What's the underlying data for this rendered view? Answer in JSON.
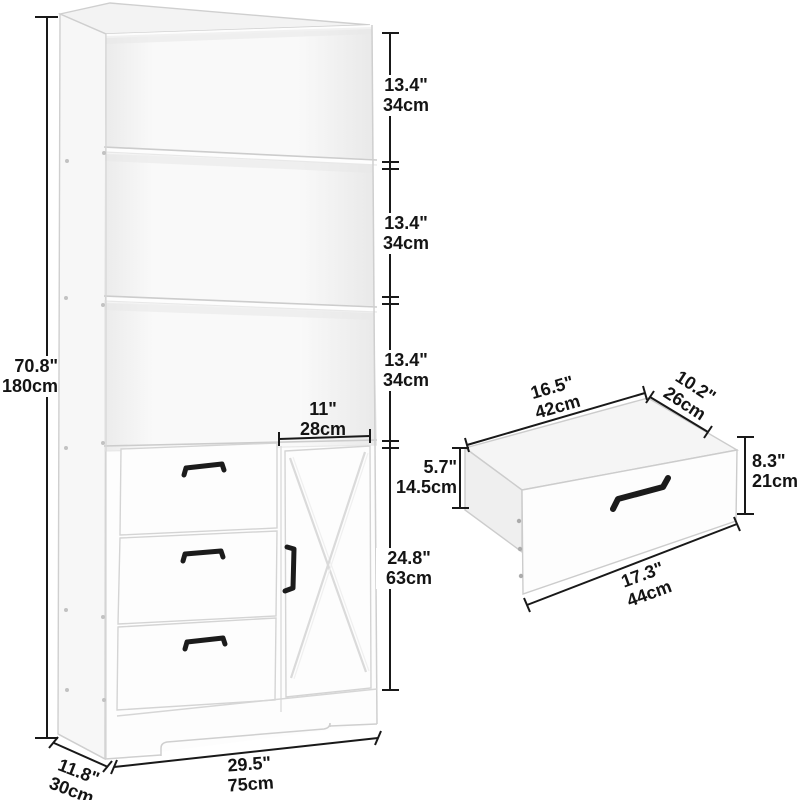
{
  "cabinet": {
    "overall_height": {
      "in": "70.8\"",
      "cm": "180cm"
    },
    "shelf_sections": [
      {
        "in": "13.4\"",
        "cm": "34cm"
      },
      {
        "in": "13.4\"",
        "cm": "34cm"
      },
      {
        "in": "13.4\"",
        "cm": "34cm"
      }
    ],
    "door_width": {
      "in": "11\"",
      "cm": "28cm"
    },
    "lower_section_height": {
      "in": "24.8\"",
      "cm": "63cm"
    },
    "depth": {
      "in": "11.8\"",
      "cm": "30cm"
    },
    "width": {
      "in": "29.5\"",
      "cm": "75cm"
    }
  },
  "drawer_detail": {
    "top_width": {
      "in": "16.5\"",
      "cm": "42cm"
    },
    "top_depth": {
      "in": "10.2\"",
      "cm": "26cm"
    },
    "side_height": {
      "in": "5.7\"",
      "cm": "14.5cm"
    },
    "front_height": {
      "in": "8.3\"",
      "cm": "21cm"
    },
    "bottom_width": {
      "in": "17.3\"",
      "cm": "44cm"
    }
  },
  "style": {
    "dimension_line_color": "#191919",
    "edge_color": "#cfcfcf",
    "handle_color": "#1b1b1b",
    "background": "#ffffff"
  }
}
